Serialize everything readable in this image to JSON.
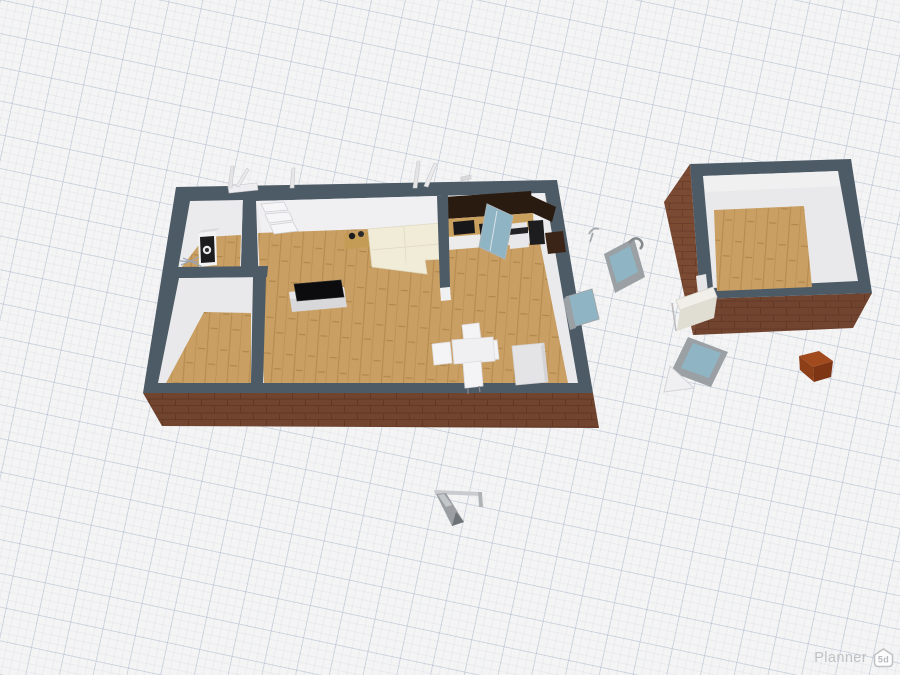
{
  "app": {
    "watermark": {
      "label": "Planner",
      "badge": "5d"
    }
  },
  "palette": {
    "background": "#f4f4f5",
    "grid_line": "#94a4bc",
    "wall_cap": "#4d5b66",
    "wall_inner": "#eaeaec",
    "brick": "#7a4a33",
    "brick_mortar": "#6a3c28",
    "floor_wood": "#c99f63",
    "floor_wood_stripe": "#b78c51",
    "glass": "#8fb4c4",
    "door_frame": "#9aa0a4",
    "sofa": "#f1ecd8",
    "cabinet_dark": "#2a1b10",
    "appliance_dark": "#17171a",
    "tv_screen": "#0c0c0e",
    "crate_brown": "#a04a1e",
    "watermark_text": "#c0c2c4"
  }
}
